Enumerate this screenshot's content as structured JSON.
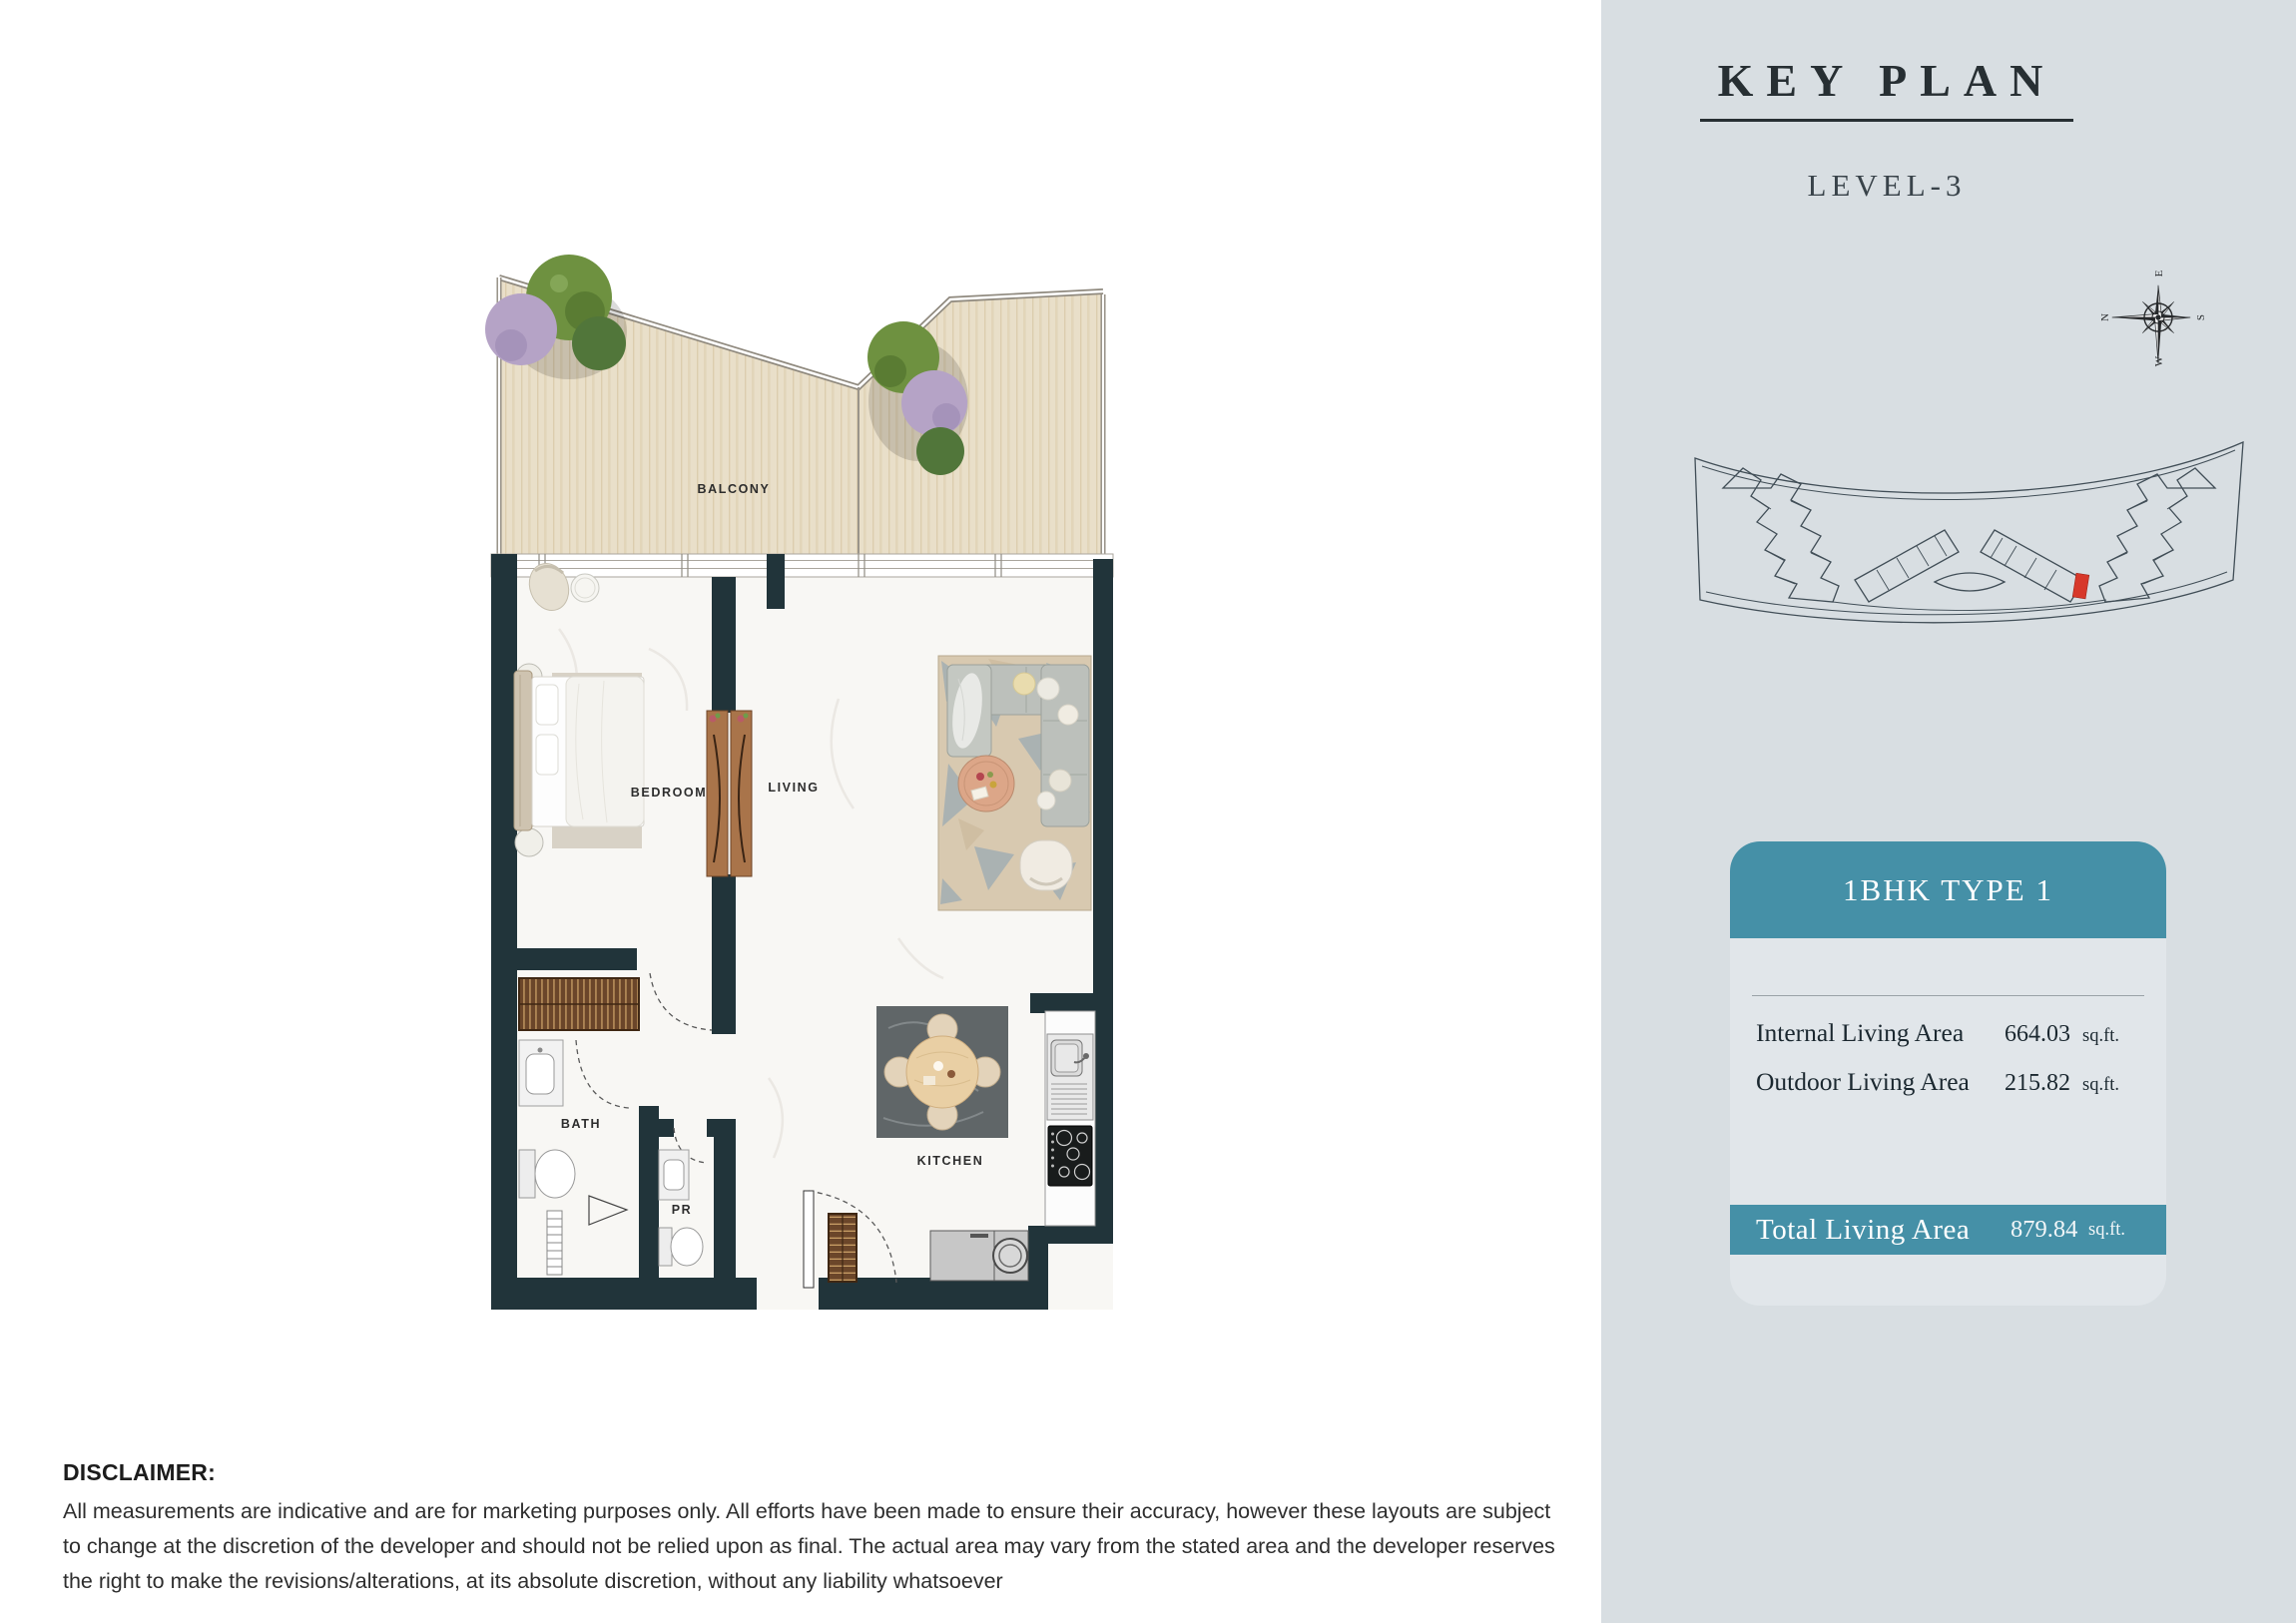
{
  "key_plan": {
    "title": "KEY PLAN",
    "level": "LEVEL-3"
  },
  "compass": {
    "north": "N",
    "east": "E",
    "south": "S",
    "west": "W"
  },
  "unit_card": {
    "title": "1BHK TYPE 1",
    "rows": [
      {
        "label": "Internal Living Area",
        "value": "664.03",
        "unit": "sq.ft."
      },
      {
        "label": "Outdoor Living Area",
        "value": "215.82",
        "unit": "sq.ft."
      }
    ],
    "total": {
      "label": "Total Living Area",
      "value": "879.84",
      "unit": "sq.ft."
    }
  },
  "floor_plan": {
    "rooms": [
      {
        "label": "BALCONY"
      },
      {
        "label": "BEDROOM"
      },
      {
        "label": "LIVING"
      },
      {
        "label": "BATH"
      },
      {
        "label": "PR"
      },
      {
        "label": "KITCHEN"
      }
    ]
  },
  "disclaimer": {
    "heading": "DISCLAIMER:",
    "body": "All measurements are indicative and are for marketing purposes only. All efforts have been made to ensure their accuracy, however these layouts are subject to change at the discretion of the developer and should not be relied upon as final. The actual area may vary from the stated area and the developer reserves the right to make the revisions/alterations, at its absolute discretion, without any liability whatsoever"
  },
  "colors": {
    "accent_teal": "#4590a7",
    "panel_bg": "#d8dee2",
    "wall": "#21343a",
    "highlight_red": "#d7382a"
  }
}
